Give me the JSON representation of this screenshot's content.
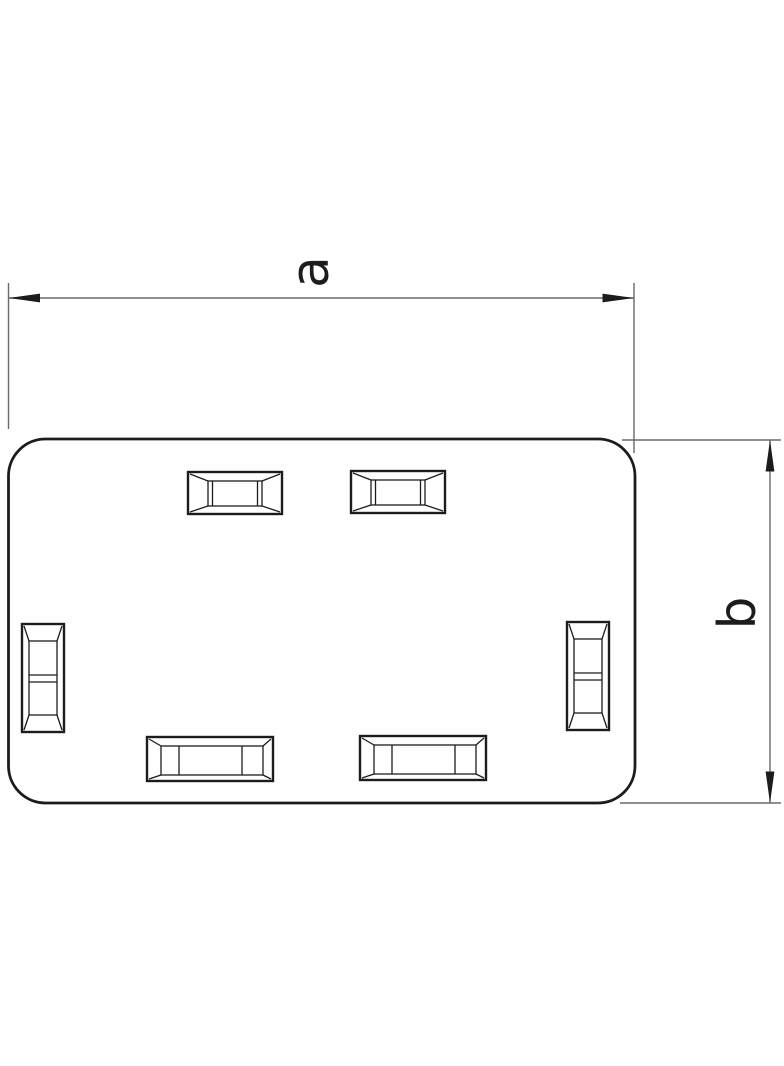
{
  "drawing": {
    "figure_name": "rounded-rectangular-end-piece-with-six-knockout-slots",
    "dimensions": {
      "width": {
        "label": "a"
      },
      "height": {
        "label": "b"
      }
    },
    "colors": {
      "outline": "#1c1c1c",
      "dimension_lines": "#6a6a6a",
      "background": "#ffffff"
    }
  }
}
